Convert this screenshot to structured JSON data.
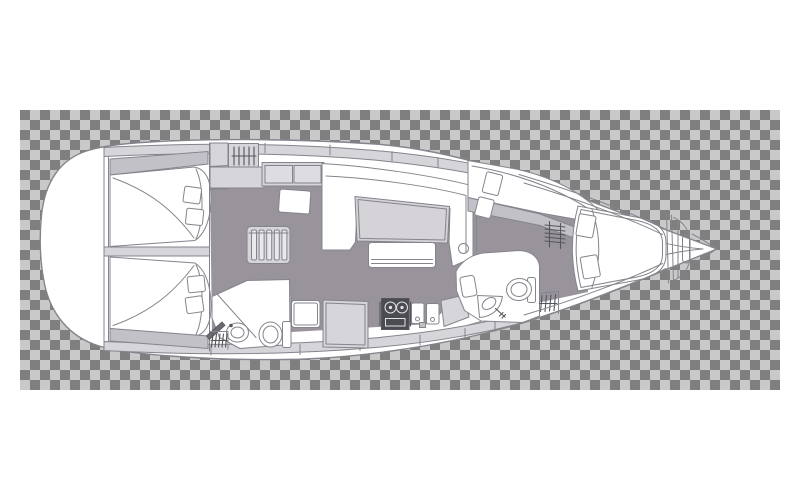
{
  "document": {
    "title": "Sailing yacht interior layout plan (top view, bow to the right)",
    "type": "yacht-floorplan-diagram",
    "background": "transparency-checkerboard"
  },
  "colors": {
    "checker_dark": "#7f7f7f",
    "checker_light": "#c9c9c9",
    "page_white": "#ffffff",
    "hull_white": "#ffffff",
    "outline": "#84848c",
    "outline_dark": "#55555c",
    "deck_band": "#d6d5d9",
    "furniture_light": "#d5d3d7",
    "furniture_mid": "#c2c1c7",
    "floor": "#99949b",
    "stove": "#4b4b52",
    "stove_detail": "#e3e3e6",
    "slat_fill": "#e9e9ec",
    "door_blade": "#6b6b72",
    "panel_fill": "#dddce0"
  },
  "canvas": {
    "width": 800,
    "height": 500,
    "checker_area": {
      "x": 20,
      "y": 110,
      "w": 760,
      "h": 280,
      "square": 10
    }
  },
  "areas": [
    {
      "name": "stern-platform",
      "features": [
        "transom",
        "lazarette"
      ]
    },
    {
      "name": "aft-cabin-port",
      "features": [
        "double-berth",
        "pillow",
        "pillow",
        "cockpit-locker-wedge"
      ]
    },
    {
      "name": "aft-cabin-starboard",
      "features": [
        "double-berth",
        "pillow",
        "pillow",
        "cockpit-locker-wedge"
      ]
    },
    {
      "name": "companionway",
      "features": [
        "steps",
        "locker",
        "louvered-locker",
        "stool"
      ]
    },
    {
      "name": "aft-heads",
      "features": [
        "washbasin",
        "toilet",
        "shower-pan",
        "door",
        "vent-grate"
      ]
    },
    {
      "name": "saloon",
      "features": [
        "u-settee",
        "saloon-table",
        "bench-seat",
        "sideboard-cabinet",
        "mast-post"
      ]
    },
    {
      "name": "galley",
      "features": [
        "worktop",
        "counter-lockers",
        "two-burner-stove",
        "double-sink",
        "counter"
      ]
    },
    {
      "name": "forward-heads",
      "features": [
        "corner-washbasin",
        "toilet",
        "shower-grate",
        "door-leaf"
      ]
    },
    {
      "name": "forward-cabin",
      "features": [
        "side-berth",
        "pillow",
        "pillow",
        "island-berth",
        "pillow",
        "pillow",
        "louvered-wardrobe"
      ]
    },
    {
      "name": "bow",
      "features": [
        "collision-bulkhead",
        "anchor-locker"
      ]
    }
  ],
  "pillow_count": 8,
  "heads_count": 2,
  "cabin_count": 3
}
